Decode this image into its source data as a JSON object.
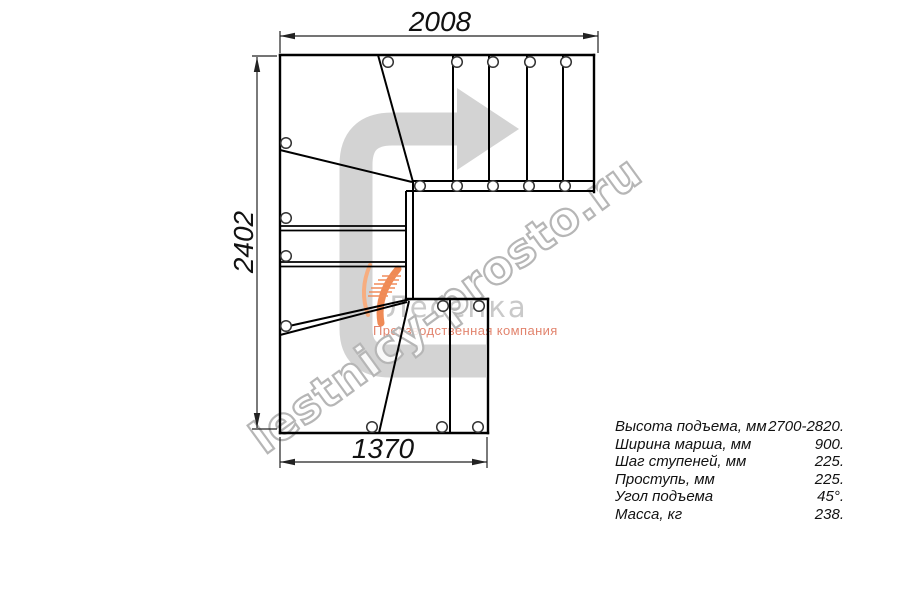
{
  "watermark": {
    "text": "lestnicy-prosto.ru"
  },
  "logo": {
    "name": "Лесенка",
    "tagline": "Производственная компания"
  },
  "dimensions": {
    "top": "2008",
    "left": "2402",
    "bottom": "1370"
  },
  "specs": {
    "rows": [
      {
        "label": "Высота подъема, мм",
        "value": "2700-2820."
      },
      {
        "label": "Ширина марша, мм",
        "value": "900."
      },
      {
        "label": "Шаг ступеней, мм",
        "value": "225."
      },
      {
        "label": "Проступь, мм",
        "value": "225."
      },
      {
        "label": "Угол подъема",
        "value": "45°."
      },
      {
        "label": "Масса, кг",
        "value": "238."
      }
    ]
  },
  "colors": {
    "plan_line": "#000000",
    "dimension_line": "#222222",
    "direction_arrow": "#d3d3d3",
    "watermark_outline": "#b6b6b6",
    "logo_gray": "#c9c9c9",
    "logo_orange": "#ef8a55",
    "logo_tagline": "#e2846e"
  }
}
